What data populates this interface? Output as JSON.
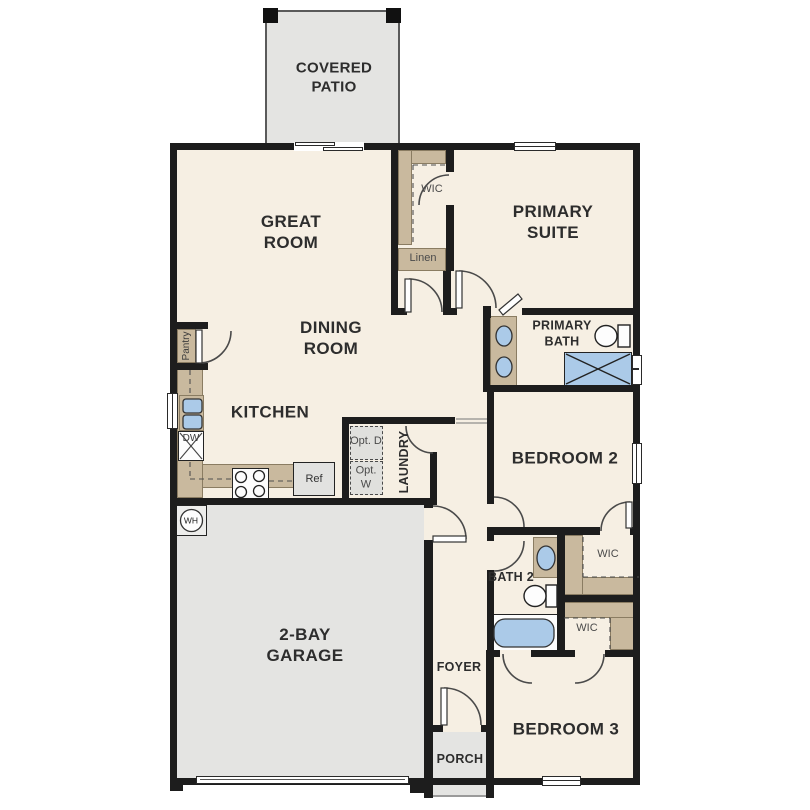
{
  "floorplan": {
    "title": "single-story house floor plan",
    "labels": {
      "covered_patio": "COVERED PATIO",
      "great_room": "GREAT ROOM",
      "primary_suite": "PRIMARY SUITE",
      "wic_primary": "WIC",
      "linen": "Linen",
      "dining_room": "DINING ROOM",
      "primary_bath": "PRIMARY BATH",
      "pantry": "Pantry",
      "kitchen": "KITCHEN",
      "dishwasher": "DW",
      "opt_dryer": "Opt. D",
      "opt_washer": "Opt. W",
      "laundry": "LAUNDRY",
      "refrigerator": "Ref",
      "bedroom_2": "BEDROOM 2",
      "water_heater": "WH",
      "wic_bedroom2": "WIC",
      "bath_2": "BATH 2",
      "wic_bedroom3": "WIC",
      "garage": "2-BAY GARAGE",
      "foyer": "FOYER",
      "bedroom_3": "BEDROOM 3",
      "porch": "PORCH"
    },
    "colors": {
      "floor": "#f6efe3",
      "outdoor_concrete": "#e4e4e2",
      "wall": "#1d1d1d",
      "cabinetry": "#c9b99e",
      "plumbing_fixture_blue": "#abcae8",
      "label_dark": "#2d2d2d",
      "label_gray": "#4a4a4a"
    }
  }
}
